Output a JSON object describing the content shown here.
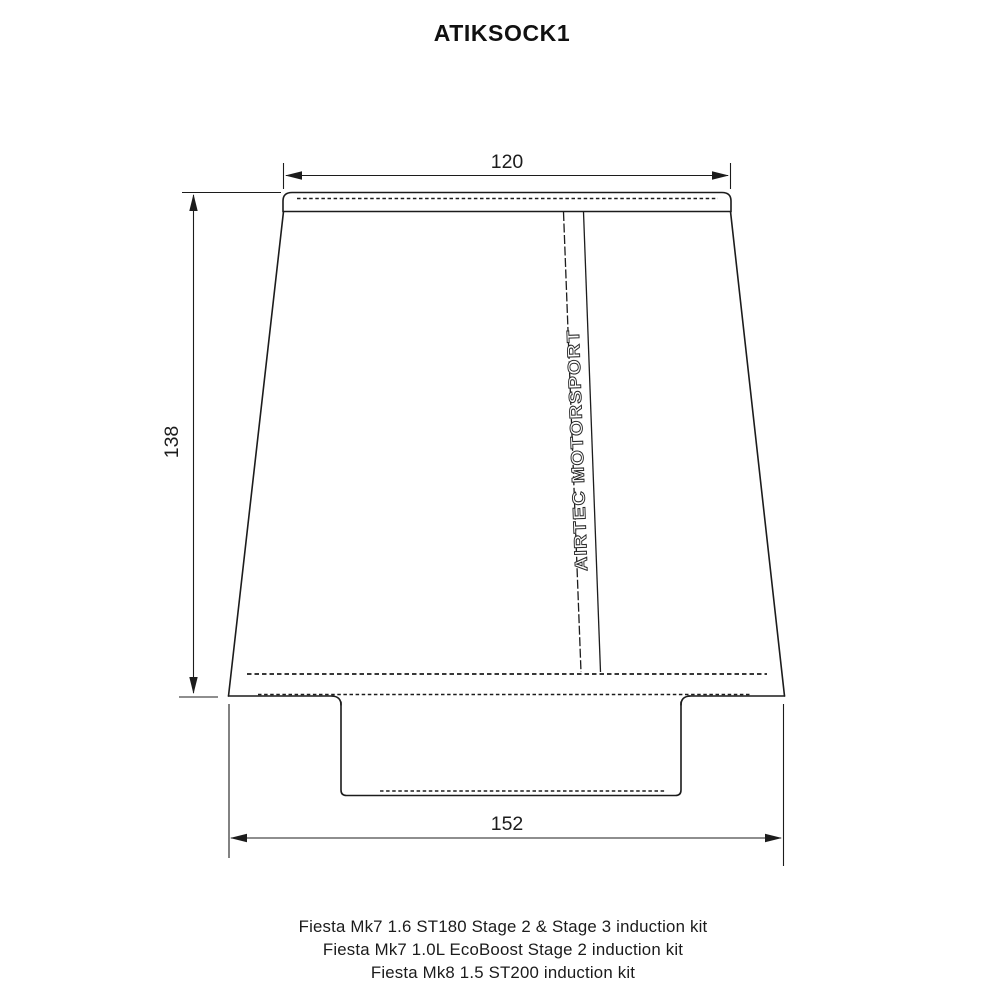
{
  "title": "ATIKSOCK1",
  "drawing": {
    "brand_label": "AIRTEC MOTORSPORT",
    "dimensions": {
      "top_width": "120",
      "height": "138",
      "base_width": "152"
    }
  },
  "footer": {
    "lines": [
      "Fiesta Mk7 1.6 ST180 Stage 2 & Stage 3 induction kit",
      "Fiesta Mk7 1.0L EcoBoost Stage 2 induction kit",
      "Fiesta Mk8 1.5 ST200 induction kit"
    ]
  },
  "colors": {
    "line": "#1c1c1c",
    "background": "#ffffff"
  }
}
